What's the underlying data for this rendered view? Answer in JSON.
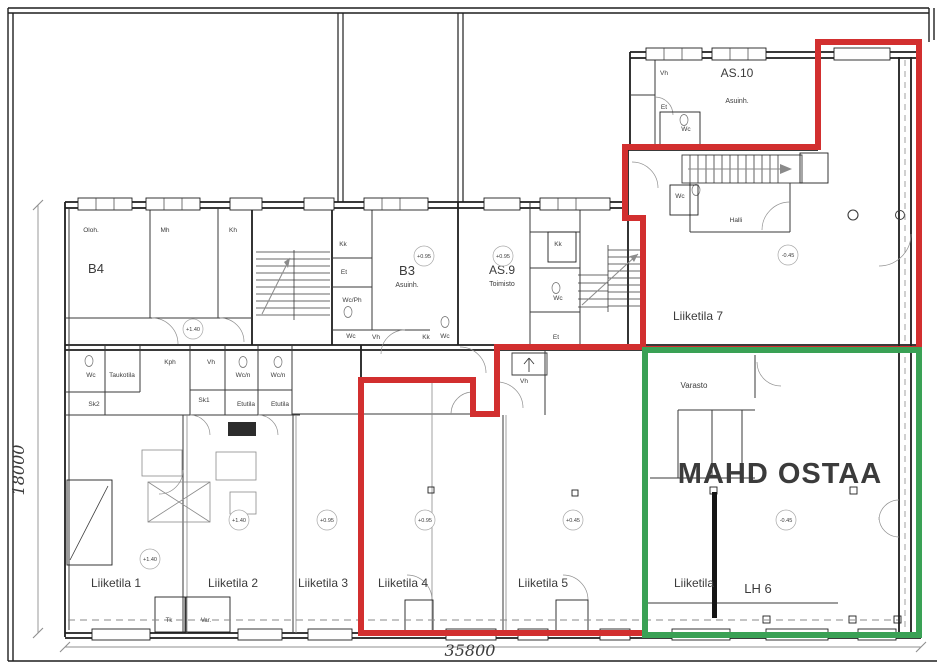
{
  "drawing": {
    "type": "architectural-floor-plan",
    "colors": {
      "highlight_red": "#d22f2f",
      "highlight_green": "#3aa155",
      "annotation_green": "#3c9e52",
      "wall": "#1f1f1f",
      "muted": "#8f8f8f"
    },
    "dimensions": {
      "left_vertical": "18000",
      "bottom_horizontal": "35800"
    },
    "annotation": "MAHD OSTAA"
  },
  "labels": [
    {
      "n": "room-b4",
      "t": "B4",
      "x": 96,
      "y": 273,
      "s": 13
    },
    {
      "n": "room-b3",
      "t": "B3",
      "x": 407,
      "y": 275,
      "s": 13
    },
    {
      "n": "room-b3-sub",
      "t": "Asuinh.",
      "x": 407,
      "y": 287,
      "s": 7
    },
    {
      "n": "room-as9",
      "t": "AS.9",
      "x": 502,
      "y": 274,
      "s": 12
    },
    {
      "n": "room-as9-sub",
      "t": "Toimisto",
      "x": 502,
      "y": 286,
      "s": 7
    },
    {
      "n": "room-as10",
      "t": "AS.10",
      "x": 737,
      "y": 77,
      "s": 12
    },
    {
      "n": "room-as10-sub",
      "t": "Asuinh.",
      "x": 737,
      "y": 103,
      "s": 7
    },
    {
      "n": "room-liiketila-7",
      "t": "Liiketila 7",
      "x": 698,
      "y": 320,
      "s": 12
    },
    {
      "n": "room-liiketila-1",
      "t": "Liiketila 1",
      "x": 116,
      "y": 587,
      "s": 12
    },
    {
      "n": "room-liiketila-2",
      "t": "Liiketila 2",
      "x": 233,
      "y": 587,
      "s": 12
    },
    {
      "n": "room-liiketila-3",
      "t": "Liiketila 3",
      "x": 323,
      "y": 587,
      "s": 12
    },
    {
      "n": "room-liiketila-4",
      "t": "Liiketila 4",
      "x": 403,
      "y": 587,
      "s": 12
    },
    {
      "n": "room-liiketila-5",
      "t": "Liiketila 5",
      "x": 543,
      "y": 587,
      "s": 12
    },
    {
      "n": "room-liiketila-6",
      "t": "Liiketila",
      "x": 694,
      "y": 587,
      "s": 12
    },
    {
      "n": "room-lh6",
      "t": "LH 6",
      "x": 758,
      "y": 593,
      "s": 13
    },
    {
      "n": "room-varasto",
      "t": "Varasto",
      "x": 694,
      "y": 388,
      "s": 8
    },
    {
      "n": "annotation-mahd-ostaa",
      "t": "MAHD OSTAA",
      "x": 780,
      "y": 483,
      "s": 29,
      "w": "bold",
      "c": "annotation_green",
      "ls": 1
    },
    {
      "n": "dim-bottom",
      "t": "35800",
      "x": 470,
      "y": 656,
      "s": 16,
      "c": "muted",
      "ff": "serif",
      "it": 1
    },
    {
      "n": "dim-left",
      "t": "18000",
      "x": 24,
      "y": 470,
      "s": 16,
      "c": "muted",
      "ff": "serif",
      "it": 1,
      "r": -90
    },
    {
      "n": "small-oloh",
      "t": "Oloh.",
      "x": 91,
      "y": 232,
      "s": 6.5
    },
    {
      "n": "small-mh",
      "t": "Mh",
      "x": 165,
      "y": 232,
      "s": 6.5
    },
    {
      "n": "small-kh",
      "t": "Kh",
      "x": 233,
      "y": 232,
      "s": 6.5
    },
    {
      "n": "small-kk-1",
      "t": "Kk",
      "x": 343,
      "y": 246,
      "s": 6.5
    },
    {
      "n": "small-et-1",
      "t": "Et",
      "x": 344,
      "y": 274,
      "s": 6.5
    },
    {
      "n": "small-wcph",
      "t": "Wc/Ph",
      "x": 352,
      "y": 302,
      "s": 6.5
    },
    {
      "n": "small-wc-1",
      "t": "Wc",
      "x": 351,
      "y": 338,
      "s": 6.5
    },
    {
      "n": "small-vh-1",
      "t": "Vh",
      "x": 376,
      "y": 339,
      "s": 6.5
    },
    {
      "n": "small-kk-2",
      "t": "Kk",
      "x": 426,
      "y": 339,
      "s": 6.5
    },
    {
      "n": "small-wc-2",
      "t": "Wc",
      "x": 445,
      "y": 338,
      "s": 6.5
    },
    {
      "n": "small-kk-3",
      "t": "Kk",
      "x": 558,
      "y": 246,
      "s": 6.5
    },
    {
      "n": "small-wc-3",
      "t": "Wc",
      "x": 558,
      "y": 300,
      "s": 6.5
    },
    {
      "n": "small-et-2",
      "t": "Et",
      "x": 556,
      "y": 339,
      "s": 6.5
    },
    {
      "n": "small-vh-2",
      "t": "Vh",
      "x": 524,
      "y": 383,
      "s": 6.5
    },
    {
      "n": "small-vh-3",
      "t": "Vh",
      "x": 664,
      "y": 75,
      "s": 6.5
    },
    {
      "n": "small-et-3",
      "t": "Et",
      "x": 664,
      "y": 109,
      "s": 6.5
    },
    {
      "n": "small-wc-4",
      "t": "Wc",
      "x": 686,
      "y": 131,
      "s": 6.5
    },
    {
      "n": "small-wc-5",
      "t": "Wc",
      "x": 680,
      "y": 198,
      "s": 6.5
    },
    {
      "n": "small-halli",
      "t": "Halli",
      "x": 736,
      "y": 222,
      "s": 6.5
    },
    {
      "n": "small-wc-6",
      "t": "Wc",
      "x": 91,
      "y": 377,
      "s": 6.5
    },
    {
      "n": "small-taukotila",
      "t": "Taukotila",
      "x": 122,
      "y": 377,
      "s": 6.5
    },
    {
      "n": "small-kph",
      "t": "Kph",
      "x": 170,
      "y": 364,
      "s": 6.5
    },
    {
      "n": "small-vh-4",
      "t": "Vh",
      "x": 211,
      "y": 364,
      "s": 6.5
    },
    {
      "n": "small-wcn-1",
      "t": "Wc/n",
      "x": 243,
      "y": 377,
      "s": 6.5
    },
    {
      "n": "small-wcn-2",
      "t": "Wc/n",
      "x": 278,
      "y": 377,
      "s": 6.5
    },
    {
      "n": "small-sk2",
      "t": "Sk2",
      "x": 94,
      "y": 406,
      "s": 6.5
    },
    {
      "n": "small-sk1",
      "t": "Sk1",
      "x": 204,
      "y": 402,
      "s": 6.5
    },
    {
      "n": "small-etutila-1",
      "t": "Etutila",
      "x": 246,
      "y": 406,
      "s": 6.5
    },
    {
      "n": "small-etutila-2",
      "t": "Etutila",
      "x": 280,
      "y": 406,
      "s": 6.5
    },
    {
      "n": "small-tk",
      "t": "Tk",
      "x": 169,
      "y": 622,
      "s": 6
    },
    {
      "n": "small-var",
      "t": "Var.",
      "x": 206,
      "y": 622,
      "s": 6
    }
  ],
  "elevations": [
    {
      "t": "+1.40",
      "x": 193,
      "y": 329
    },
    {
      "t": "+0.95",
      "x": 424,
      "y": 256
    },
    {
      "t": "+0.95",
      "x": 503,
      "y": 256
    },
    {
      "t": "-0.45",
      "x": 788,
      "y": 255
    },
    {
      "t": "+1.40",
      "x": 150,
      "y": 559
    },
    {
      "t": "+1.40",
      "x": 239,
      "y": 520
    },
    {
      "t": "+0.95",
      "x": 327,
      "y": 520
    },
    {
      "t": "+0.95",
      "x": 425,
      "y": 520
    },
    {
      "t": "+0.45",
      "x": 573,
      "y": 520
    },
    {
      "t": "-0.45",
      "x": 786,
      "y": 520
    }
  ]
}
